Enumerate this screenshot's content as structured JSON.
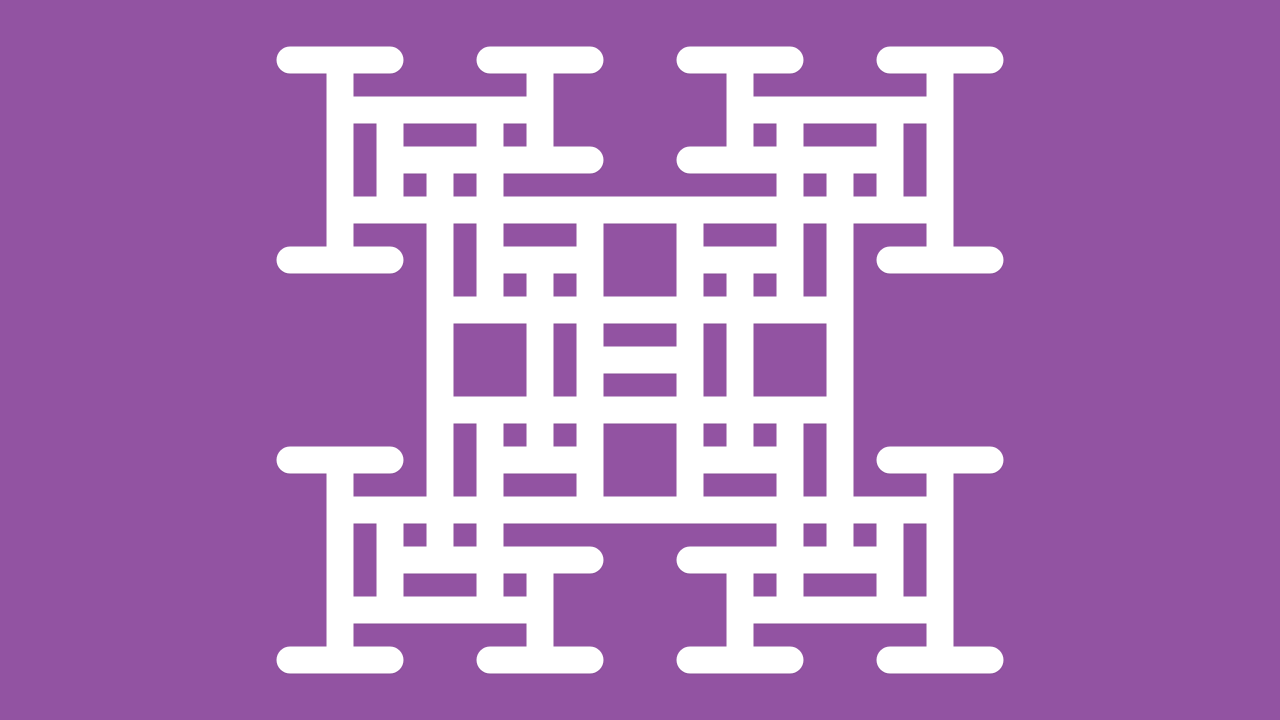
{
  "canvas": {
    "width": 1280,
    "height": 720,
    "background_color": "#9253a2"
  },
  "figure": {
    "kind": "h-tree-fractal-pattern",
    "description": "White recursive H/I-beam fractal lattice with round-capped strokes, 4-fold symmetric, centered on canvas",
    "stroke_color": "#ffffff",
    "stroke_width": 27,
    "linecap": "round",
    "shadow_color": "#5e2f6e",
    "grid_pitch": 50,
    "center": [
      640,
      360
    ],
    "segments": [
      [
        590,
        360,
        690,
        360
      ],
      [
        440,
        310,
        840,
        310
      ],
      [
        440,
        410,
        840,
        410
      ],
      [
        340,
        210,
        940,
        210
      ],
      [
        340,
        510,
        940,
        510
      ],
      [
        440,
        160,
        440,
        560
      ],
      [
        840,
        160,
        840,
        560
      ],
      [
        590,
        210,
        590,
        510
      ],
      [
        690,
        210,
        690,
        510
      ],
      [
        540,
        260,
        540,
        460
      ],
      [
        740,
        260,
        740,
        460
      ],
      [
        290,
        60,
        390,
        60
      ],
      [
        490,
        60,
        590,
        60
      ],
      [
        340,
        60,
        340,
        260
      ],
      [
        540,
        60,
        540,
        160
      ],
      [
        290,
        260,
        390,
        260
      ],
      [
        340,
        110,
        540,
        110
      ],
      [
        390,
        160,
        590,
        160
      ],
      [
        390,
        110,
        390,
        210
      ],
      [
        490,
        110,
        490,
        310
      ],
      [
        490,
        260,
        590,
        260
      ],
      [
        890,
        60,
        990,
        60
      ],
      [
        690,
        60,
        790,
        60
      ],
      [
        940,
        60,
        940,
        260
      ],
      [
        740,
        60,
        740,
        160
      ],
      [
        890,
        260,
        990,
        260
      ],
      [
        740,
        110,
        940,
        110
      ],
      [
        690,
        160,
        890,
        160
      ],
      [
        890,
        110,
        890,
        210
      ],
      [
        790,
        110,
        790,
        310
      ],
      [
        690,
        260,
        790,
        260
      ],
      [
        290,
        660,
        390,
        660
      ],
      [
        490,
        660,
        590,
        660
      ],
      [
        340,
        460,
        340,
        660
      ],
      [
        540,
        560,
        540,
        660
      ],
      [
        290,
        460,
        390,
        460
      ],
      [
        340,
        610,
        540,
        610
      ],
      [
        390,
        560,
        590,
        560
      ],
      [
        390,
        510,
        390,
        610
      ],
      [
        490,
        410,
        490,
        610
      ],
      [
        490,
        460,
        590,
        460
      ],
      [
        890,
        660,
        990,
        660
      ],
      [
        690,
        660,
        790,
        660
      ],
      [
        940,
        460,
        940,
        660
      ],
      [
        740,
        560,
        740,
        660
      ],
      [
        890,
        460,
        990,
        460
      ],
      [
        740,
        610,
        940,
        610
      ],
      [
        690,
        560,
        890,
        560
      ],
      [
        890,
        510,
        890,
        610
      ],
      [
        790,
        410,
        790,
        610
      ],
      [
        690,
        460,
        790,
        460
      ]
    ]
  }
}
